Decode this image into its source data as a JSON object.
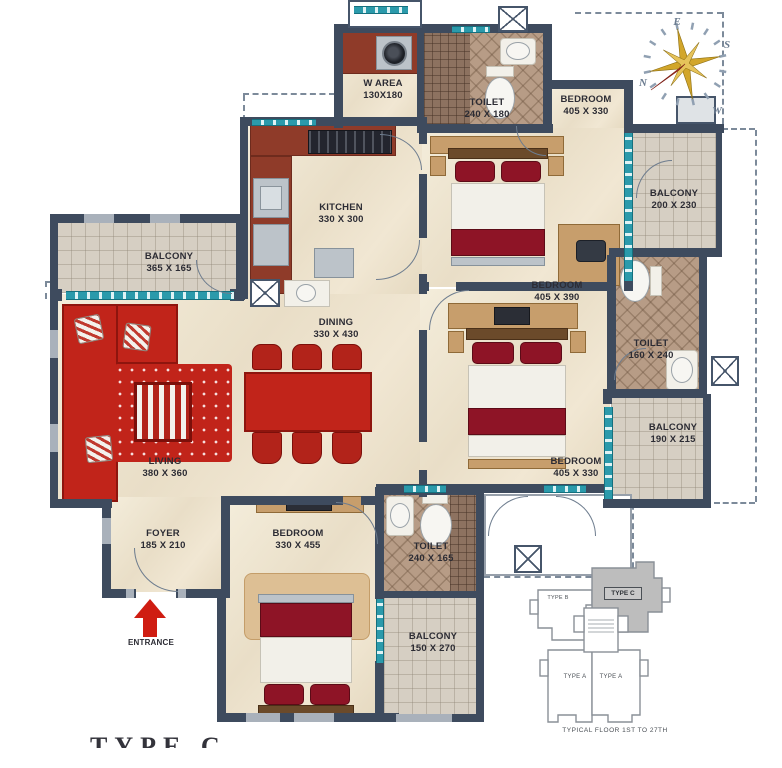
{
  "title_partial": "TYPE C",
  "entrance": {
    "label": "ENTRANCE"
  },
  "compass": {
    "top": "E",
    "right": "S",
    "left": "N",
    "bottom": "W"
  },
  "rooms": [
    {
      "name": "W AREA",
      "dims": "130X180"
    },
    {
      "name": "TOILET",
      "dims": "240 X 180"
    },
    {
      "name": "BEDROOM",
      "dims": "405 X 330"
    },
    {
      "name": "BALCONY",
      "dims": "200 X 230"
    },
    {
      "name": "KITCHEN",
      "dims": "330 X 300"
    },
    {
      "name": "BALCONY",
      "dims": "365 X 165"
    },
    {
      "name": "DINING",
      "dims": "330 X 430"
    },
    {
      "name": "BEDROOM",
      "dims": "405 X 390"
    },
    {
      "name": "TOILET",
      "dims": "160 X 240"
    },
    {
      "name": "BALCONY",
      "dims": "190 X 215"
    },
    {
      "name": "LIVING",
      "dims": "380 X 360"
    },
    {
      "name": "BEDROOM",
      "dims": "405 X 330"
    },
    {
      "name": "FOYER",
      "dims": "185 X 210"
    },
    {
      "name": "BEDROOM",
      "dims": "330 X 455"
    },
    {
      "name": "TOILET",
      "dims": "240 X 165"
    },
    {
      "name": "BALCONY",
      "dims": "150 X 270"
    }
  ],
  "keyplan": {
    "units": [
      {
        "label": "TYPE B"
      },
      {
        "label": "TYPE C"
      },
      {
        "label": "TYPE A"
      },
      {
        "label": "TYPE A"
      }
    ],
    "caption": "TYPICAL FLOOR 1ST TO 27TH"
  },
  "colors": {
    "wall": "#3e4b5e",
    "teal": "#2b9aab",
    "red": "#c1241a",
    "maroon": "#8e1426",
    "tan": "#c79e6c",
    "tile-brown": "#b79c86",
    "tile-gray": "#d6cfc3",
    "cream": "#efe5d1",
    "arrow-red": "#cf1d12"
  }
}
